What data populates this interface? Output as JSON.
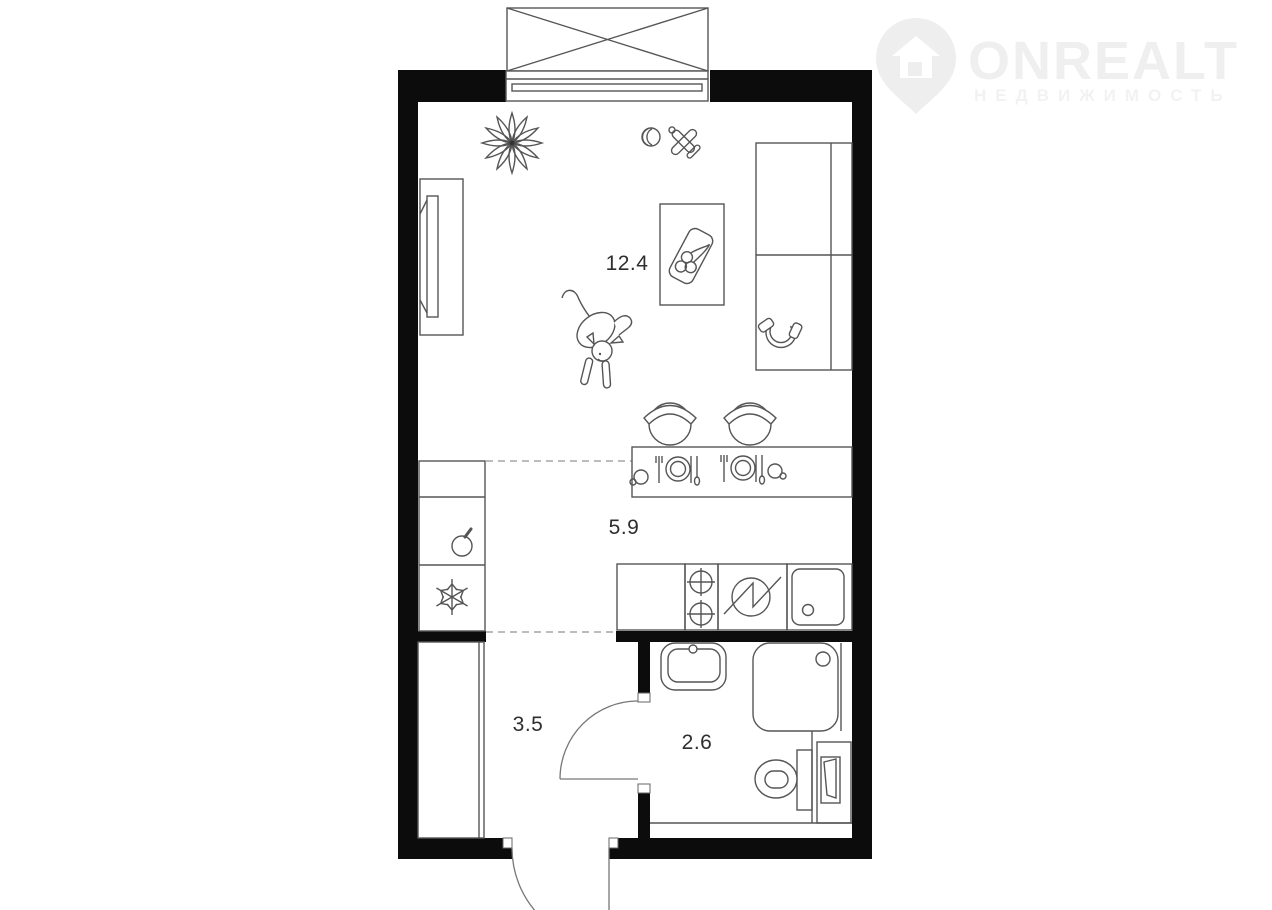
{
  "watermark": {
    "brand": "ONREALT",
    "subtitle": "НЕДВИЖИМОСТЬ",
    "color": "#efefef"
  },
  "rooms": {
    "living": {
      "label": "12.4"
    },
    "kitchen": {
      "label": "5.9"
    },
    "hallway": {
      "label": "3.5"
    },
    "bathroom": {
      "label": "2.6"
    }
  },
  "colors": {
    "wall": "#0c0c0c",
    "line": "#555555",
    "dash": "#949494",
    "background": "#ffffff"
  },
  "icons": [
    "balcony-window",
    "plant",
    "ball-toy",
    "toy-plane",
    "tv-console",
    "bed",
    "headphones",
    "coffee-table",
    "fruit-tray",
    "dog",
    "dining-table",
    "chair",
    "place-setting",
    "cup",
    "tall-cabinet",
    "apple",
    "fridge-snowflake",
    "kitchen-counter",
    "stove-burners",
    "washing-machine",
    "kitchen-sink",
    "wardrobe",
    "interior-door-swing",
    "entrance-door-swing",
    "wash-basin",
    "shower",
    "toilet",
    "water-heater",
    "map-pin-logo"
  ]
}
